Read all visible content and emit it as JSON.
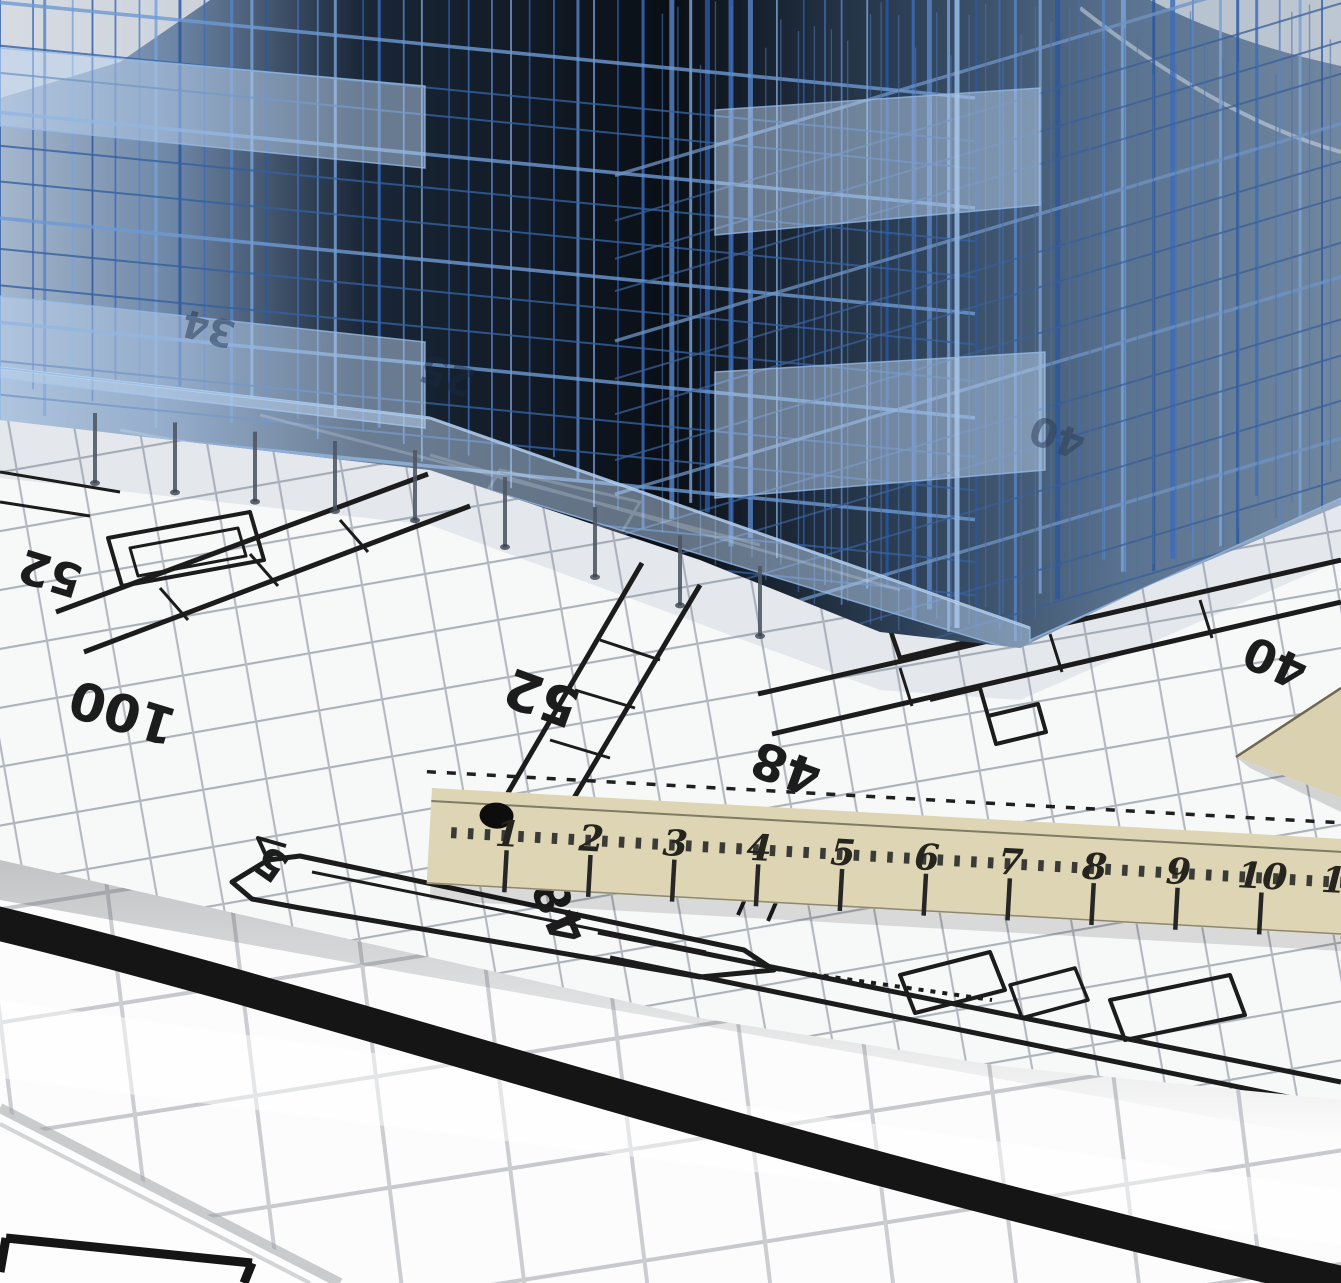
{
  "colors": {
    "wireframe_blue": "#3d6cba",
    "slab_blue": "#b9d2ee",
    "model_interior_dark": "#0a0f16",
    "paper_white": "#f7f8f8",
    "fine_grid_gray": "#acb2ba",
    "roll_grid_gray": "#c7c9cc",
    "plan_ink_black": "#1c1c1c",
    "ruler_wood_beige": "#ddd5b3",
    "ruler_ink": "#2a2822",
    "stripe_black": "#151515",
    "set_square_beige": "#d9d1b0"
  },
  "blueprint": {
    "plan_numbers": [
      {
        "text": "52"
      },
      {
        "text": "100"
      },
      {
        "text": "52"
      },
      {
        "text": "48"
      },
      {
        "text": "40"
      },
      {
        "text": "5"
      },
      {
        "text": "48"
      }
    ],
    "faint_numbers": [
      {
        "text": "34"
      },
      {
        "text": "25"
      },
      {
        "text": "40"
      }
    ]
  },
  "ruler": {
    "numbers": [
      "1",
      "2",
      "3",
      "4",
      "5",
      "6",
      "7",
      "8",
      "9",
      "10",
      "11"
    ]
  }
}
